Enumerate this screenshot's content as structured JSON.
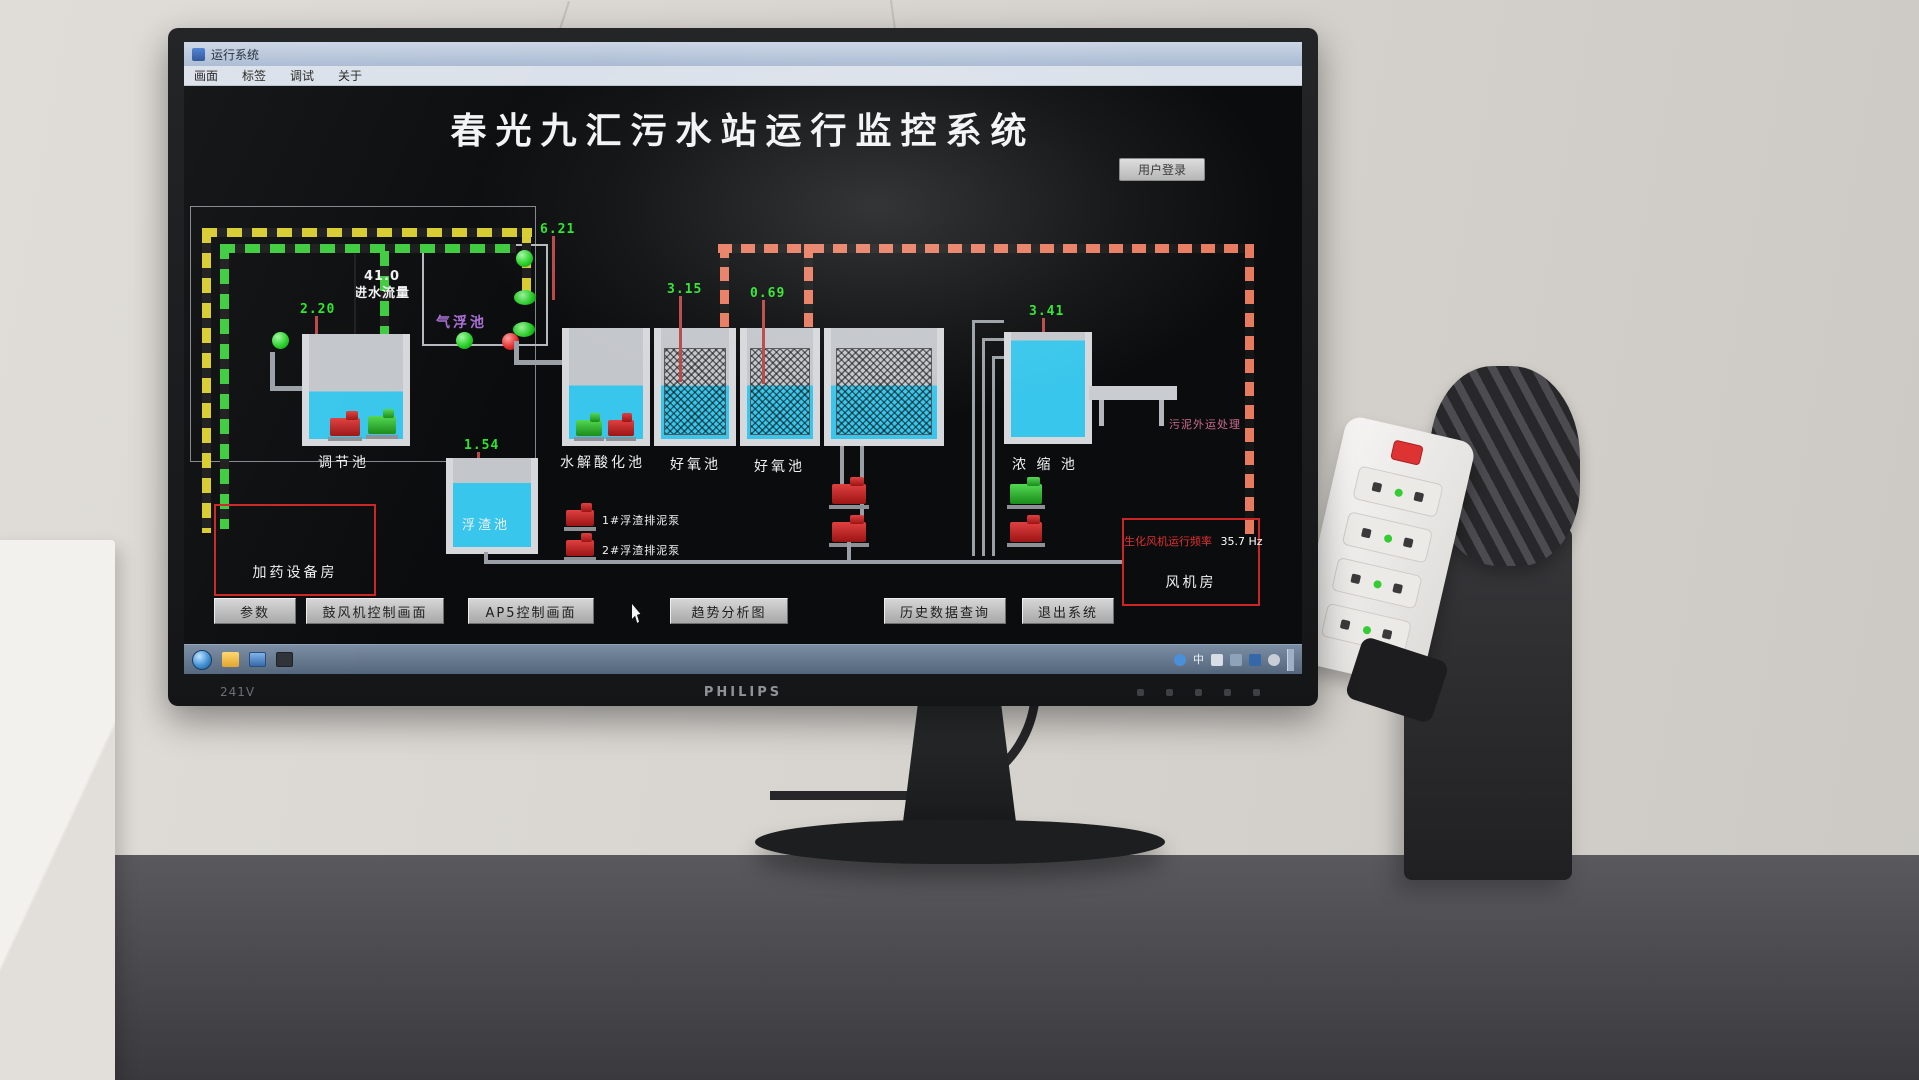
{
  "window": {
    "title": "运行系统",
    "menu_items": [
      "画面",
      "标签",
      "调试",
      "关于"
    ]
  },
  "hmi": {
    "main_title": "春光九汇污水站运行监控系统",
    "login_button": "用户登录",
    "inflow_value": "41.0",
    "inflow_label": "进水流量",
    "tanks": {
      "tiaojie": {
        "label": "调节池",
        "value": "2.20"
      },
      "qifu": {
        "label": "气浮池",
        "value": "6.21"
      },
      "fuzha": {
        "label": "浮渣池",
        "value": "1.54"
      },
      "shuijie": {
        "label": "水解酸化池"
      },
      "haoyang1": {
        "label": "好氧池",
        "value": "3.15"
      },
      "haoyang2": {
        "label": "好氧池",
        "value": "0.69"
      },
      "nongsuo": {
        "label": "浓 缩 池",
        "value": "3.41"
      }
    },
    "rooms": {
      "dosing": "加药设备房",
      "fan": "风机房"
    },
    "blower": {
      "label": "生化风机运行频率",
      "value": "35.7 Hz"
    },
    "sludge_label": "污泥外运处理",
    "pump_labels": {
      "scum1": "1#浮渣排泥泵",
      "scum2": "2#浮渣排泥泵"
    },
    "nav_buttons": [
      "参数",
      "鼓风机控制画面",
      "AP5控制画面",
      "趋势分析图",
      "历史数据查询",
      "退出系统"
    ]
  },
  "taskbar": {
    "lang_indicator": "中"
  },
  "monitor": {
    "model": "241V",
    "brand": "PHILIPS"
  },
  "colors": {
    "water": "#38c6ec",
    "value_green": "#2ce52c",
    "alarm_red": "#cc2525",
    "pipe_yellow": "#d8cc30",
    "pipe_green": "#3ecc3e",
    "pipe_red": "#e87a5e",
    "label_purple": "#a86fd4",
    "sludge_pink": "#cc6b8a"
  }
}
